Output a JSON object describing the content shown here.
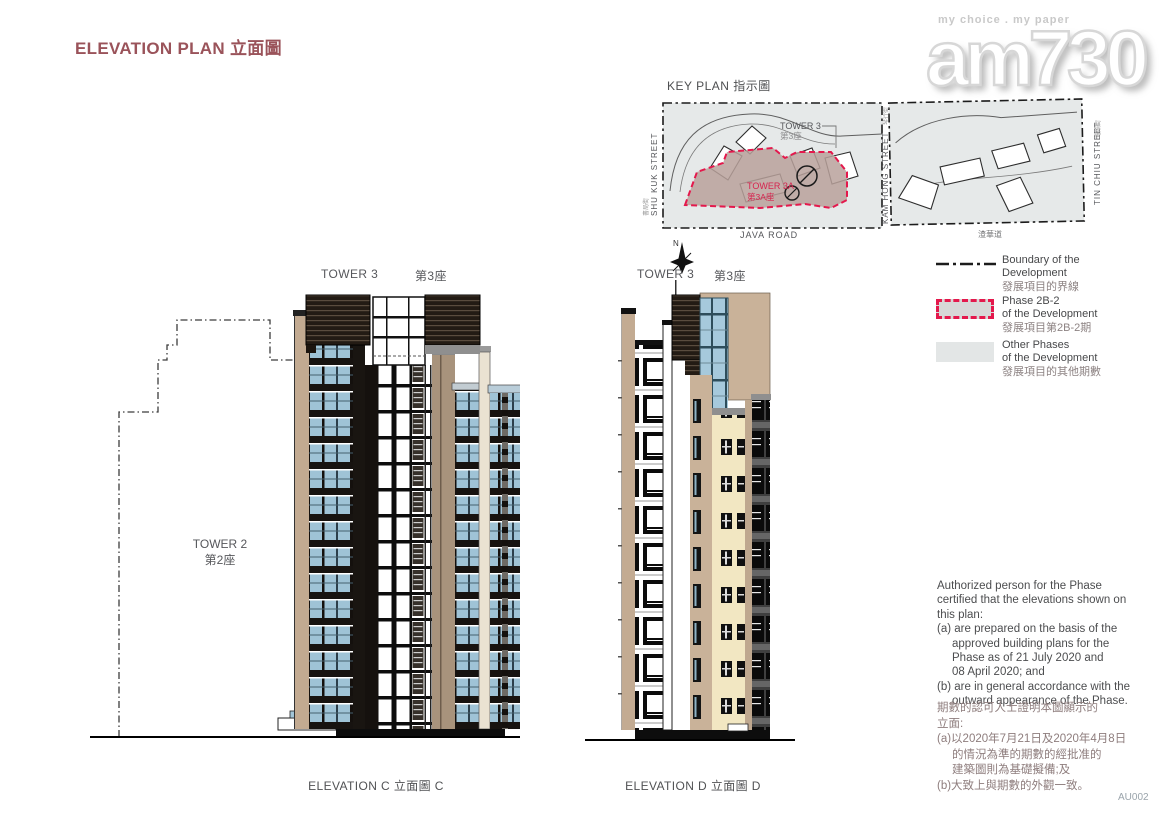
{
  "page": {
    "title": "ELEVATION PLAN 立面圖"
  },
  "watermark": {
    "tagline": "my choice . my paper",
    "logo": "am730"
  },
  "key_plan": {
    "title": "KEY PLAN 指示圖",
    "labels": {
      "tower3_en": "TOWER 3",
      "tower3_zh": "第3座",
      "tower3a_en": "TOWER 3A",
      "tower3a_zh": "第3A座",
      "shu_kuk_en": "SHU KUK STREET",
      "shu_kuk_zh": "書局街",
      "kam_hong_en": "KAM HONG STREET",
      "kam_hong_zh": "琴行街",
      "tin_chiu_en": "TIN CHIU STREET",
      "tin_chiu_zh": "電照街",
      "java_road_en": "JAVA ROAD",
      "java_road_zh": "渣華道",
      "north": "N"
    }
  },
  "legend": {
    "items": [
      {
        "line1": "Boundary of the",
        "line2": "Development",
        "zh": "發展項目的界線"
      },
      {
        "line1": "Phase 2B-2",
        "line2": "of the Development",
        "zh": "發展項目第2B-2期"
      },
      {
        "line1": "Other Phases",
        "line2": "of the Development",
        "zh": "發展項目的其他期數"
      }
    ]
  },
  "elevation_c": {
    "tower3_en": "TOWER 3",
    "tower3_zh": "第3座",
    "tower2_en": "TOWER 2",
    "tower2_zh": "第2座",
    "caption": "ELEVATION C 立面圖 C"
  },
  "elevation_d": {
    "tower3_en": "TOWER 3",
    "tower3_zh": "第3座",
    "caption": "ELEVATION D 立面圖 D"
  },
  "notes": {
    "en": [
      "Authorized person for the Phase",
      "certified that the elevations shown on",
      "this plan:",
      "(a) are prepared on the basis of the",
      "approved building plans for the",
      "Phase as of 21 July 2020 and",
      "08 April 2020; and",
      "(b) are in general accordance with the",
      "outward appearance of the Phase."
    ],
    "zh": [
      "期數的認可人士證明本圖顯示的",
      "立面:",
      "(a)以2020年7月21日及2020年4月8日",
      "的情況為準的期數的經批准的",
      "建築圖則為基礎擬備;及",
      "(b)大致上與期數的外觀一致。"
    ]
  },
  "footer": {
    "code": "AU002"
  },
  "colors": {
    "title": "#9a535a",
    "boundary_red": "#e4184c",
    "phase_fill": "#b8a19b",
    "other_phase_fill": "#e3e6e6",
    "glass_blue": "#9fc3d6",
    "facade_tan": "#c3ab92",
    "facade_cream": "#f2e7c2"
  }
}
